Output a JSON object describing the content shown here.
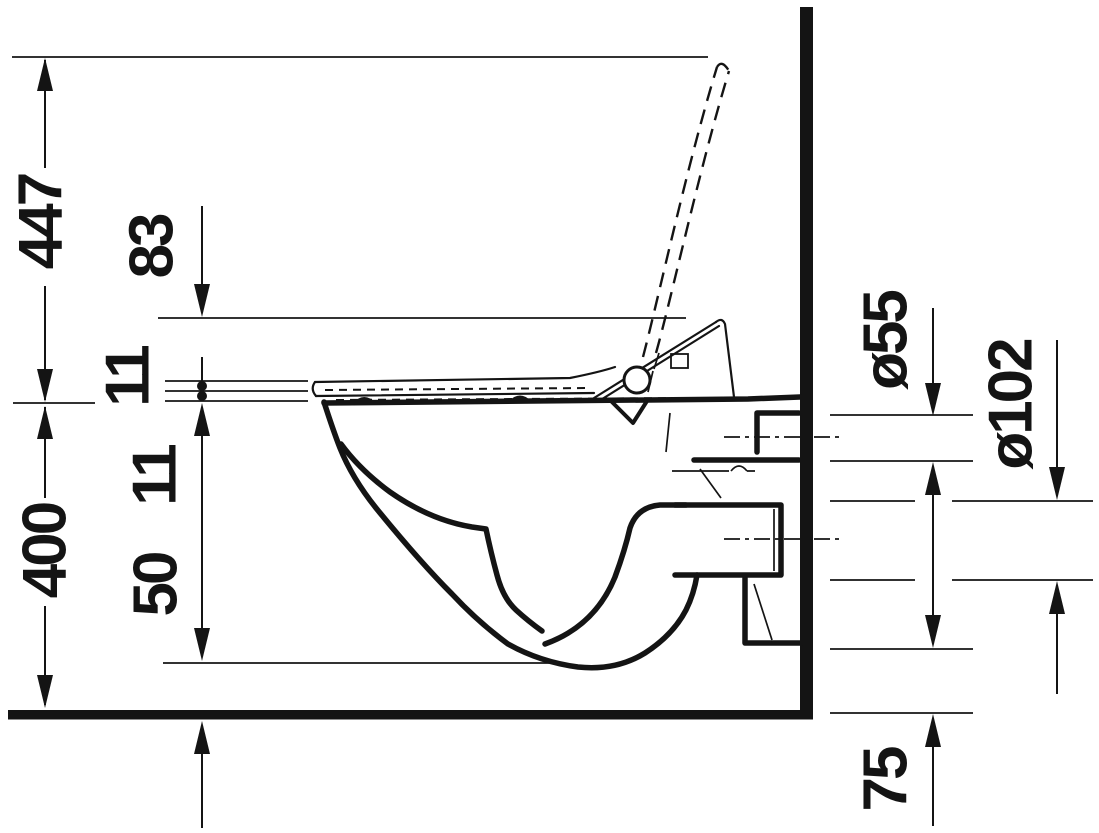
{
  "drawing": {
    "background": "#ffffff",
    "line_color": "#141414",
    "dimensions": {
      "open_lid_height": "447",
      "seat_back_height": "83",
      "seat_thickness": "11",
      "seat_clearance": "11",
      "bowl_height": "400",
      "bowl_underside_clearance": "50",
      "supply_diameter": "ø55",
      "outlet_diameter": "ø102",
      "outlet_clearance": "75"
    }
  }
}
